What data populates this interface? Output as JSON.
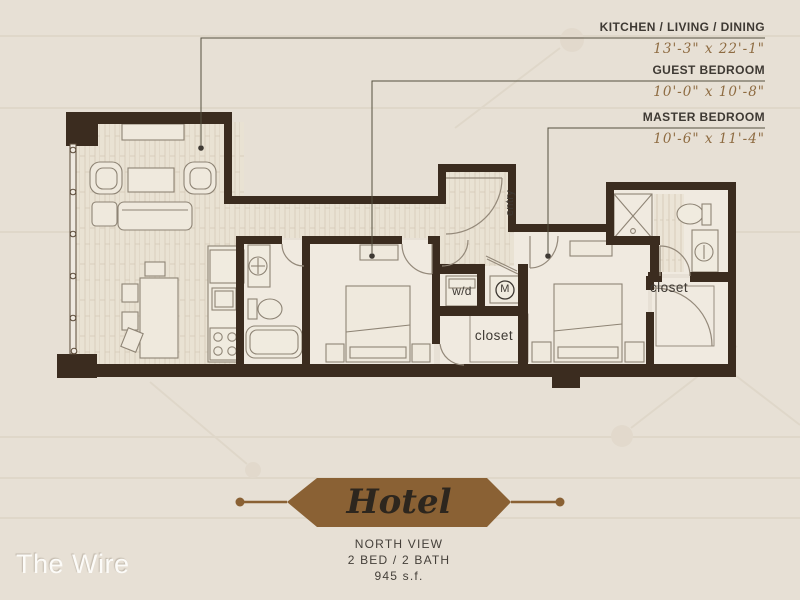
{
  "watermark": "The Wire",
  "callouts": [
    {
      "name": "KITCHEN / LIVING / DINING",
      "dims": "13'-3\" x 22'-1\""
    },
    {
      "name": "GUEST BEDROOM",
      "dims": "10'-0\" x 10'-8\""
    },
    {
      "name": "MASTER BEDROOM",
      "dims": "10'-6\" x 11'-4\""
    }
  ],
  "plan_labels": {
    "entry": "entry",
    "washer_dryer": "w/d",
    "mechanical": "M",
    "guest_closet": "closet",
    "master_closet": "closet"
  },
  "banner": {
    "title": "Hotel",
    "view": "NORTH VIEW",
    "config": "2 BED / 2 BATH",
    "area": "945 s.f."
  },
  "colors": {
    "background": "#e7e0d5",
    "wall": "#3b2c1f",
    "banner_brown": "#8a6134",
    "dimension_text": "#8e6b41",
    "label_text": "#3e3933",
    "watermark_text": "#fcfbf8"
  }
}
